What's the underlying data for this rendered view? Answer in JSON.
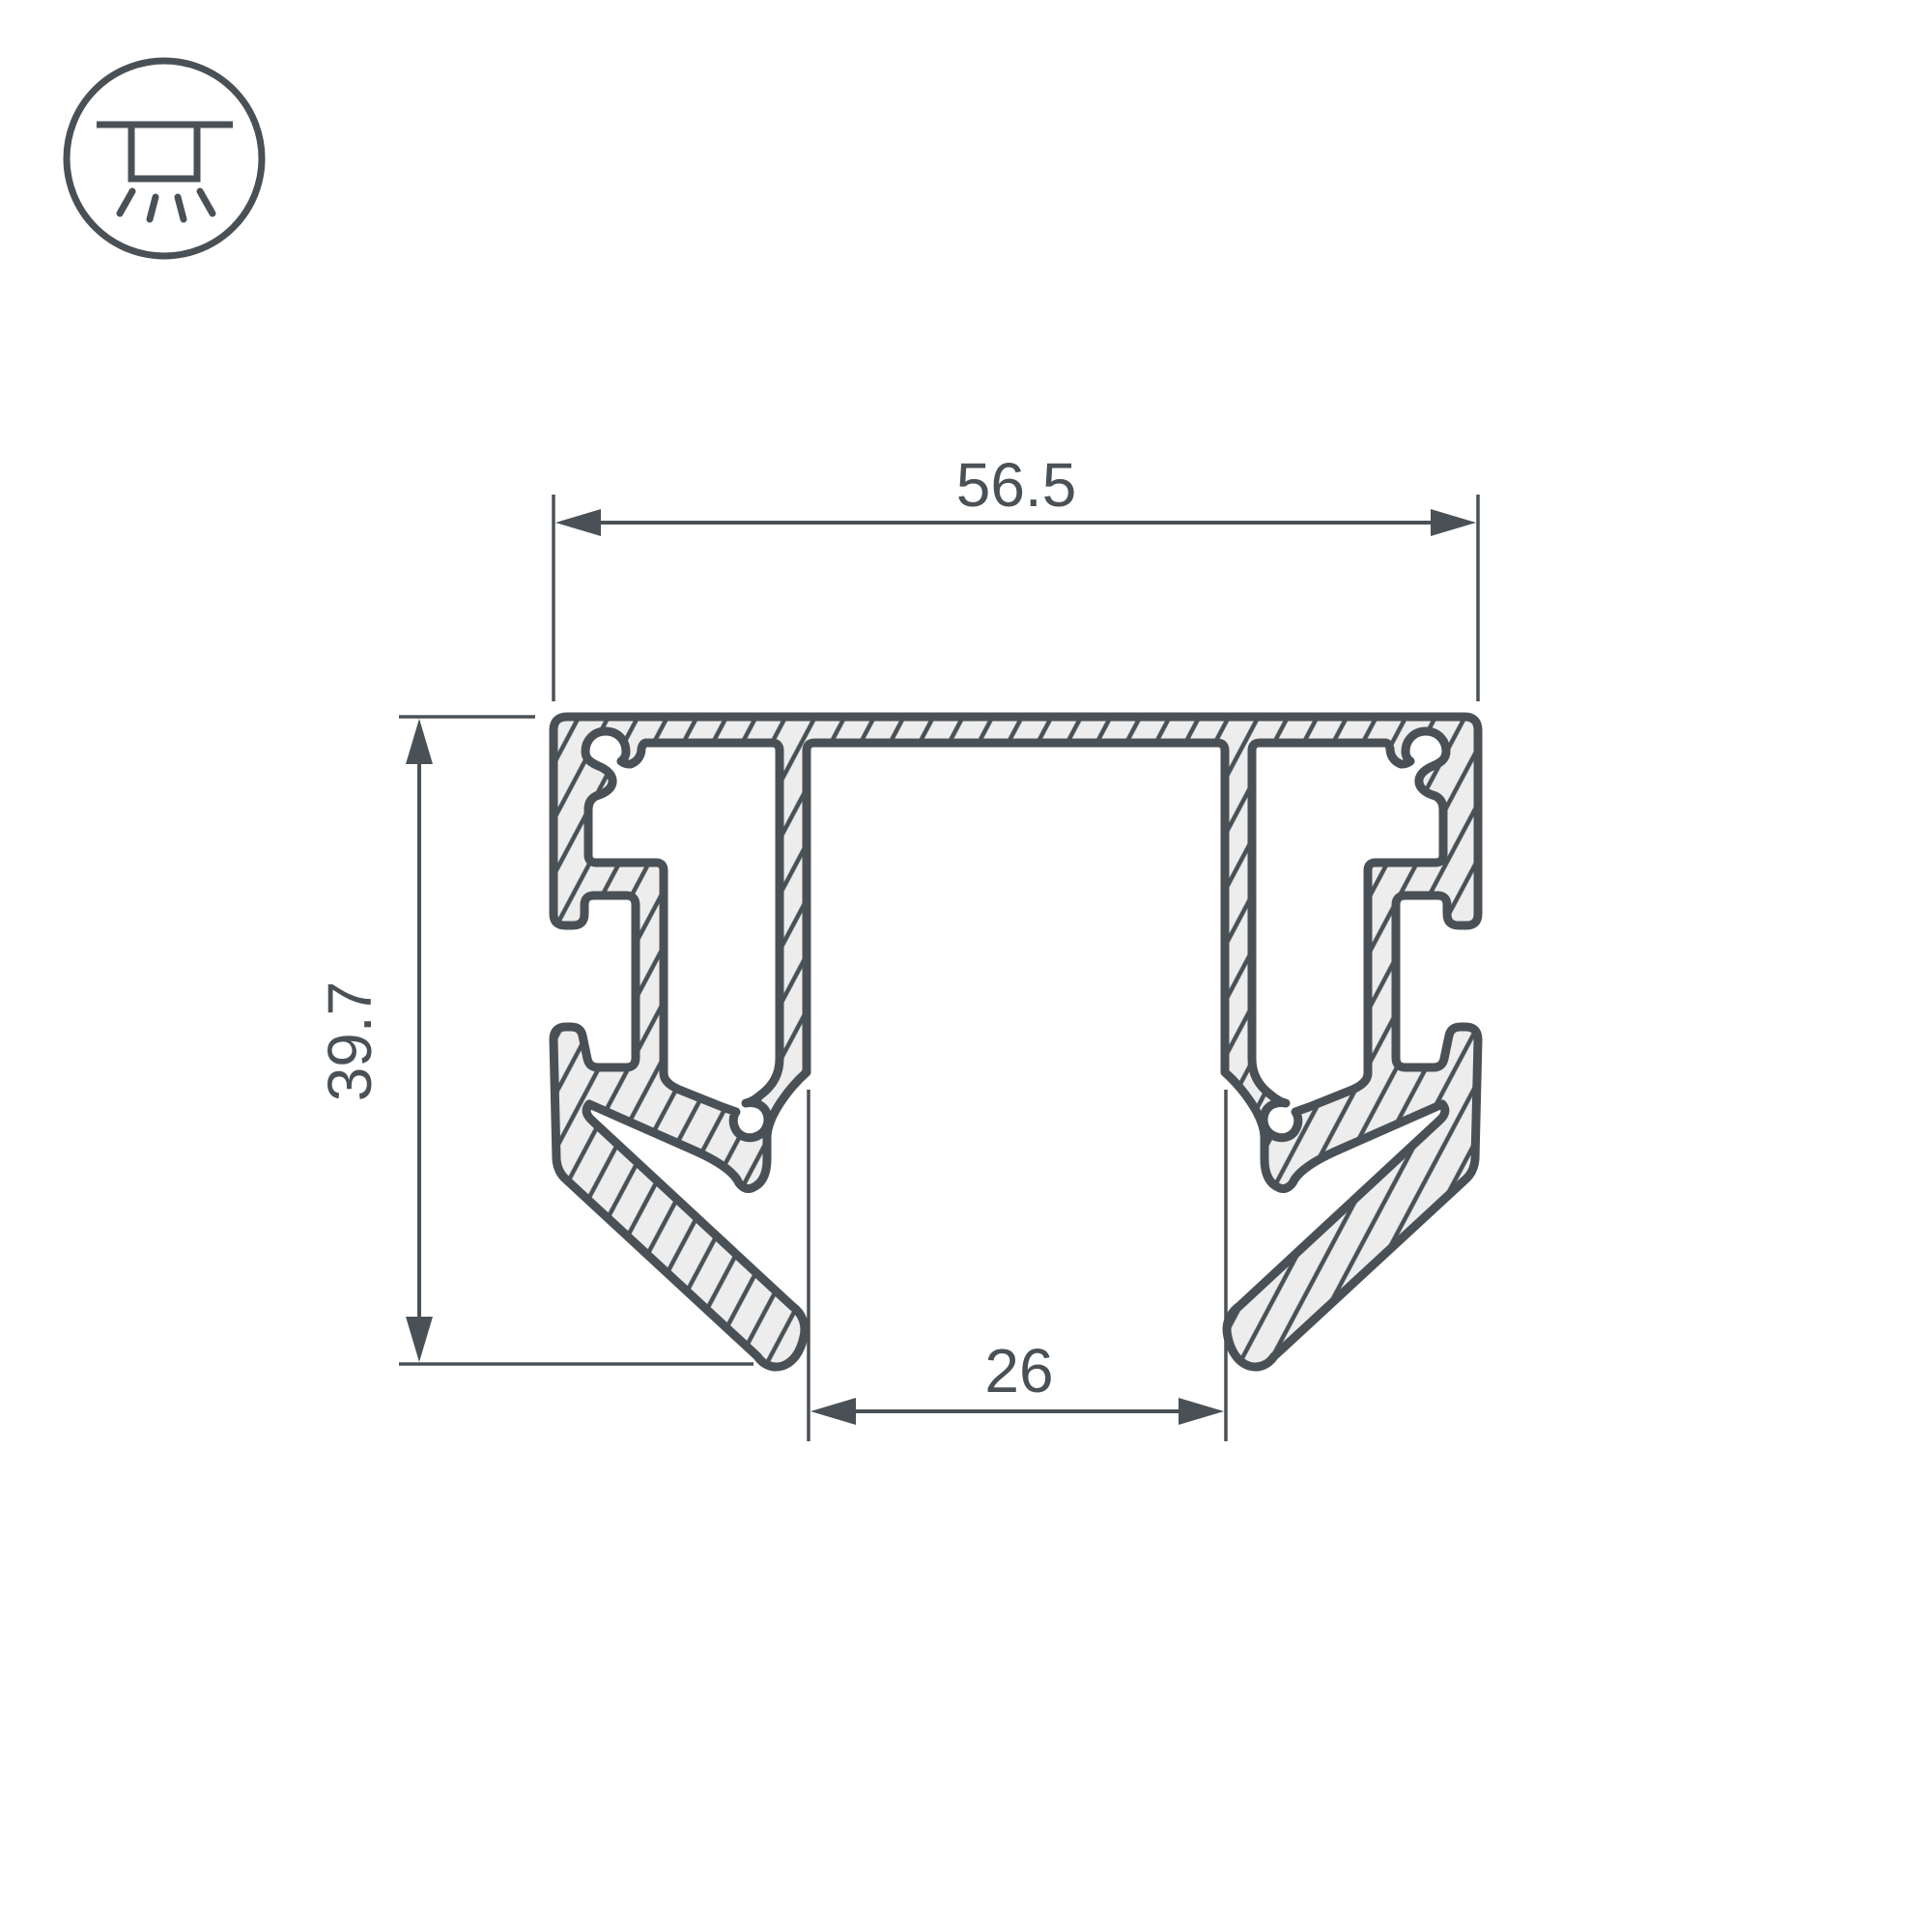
{
  "drawing": {
    "type": "profile-cross-section-technical-drawing",
    "dimensions": {
      "width": {
        "label": "56.5"
      },
      "height": {
        "label": "39.7"
      },
      "opening": {
        "label": "26"
      }
    },
    "icon": {
      "name": "ceiling-surface-mount-light-icon"
    },
    "colors": {
      "ink": "#4a5156",
      "material_fill": "#ecedec",
      "background": "#ffffff"
    }
  }
}
